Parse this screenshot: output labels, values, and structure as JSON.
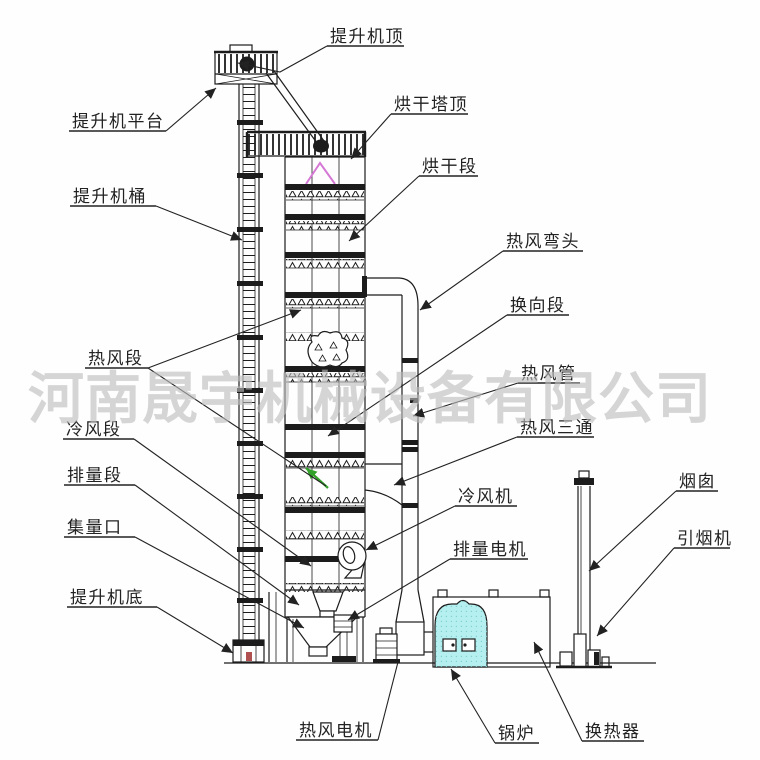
{
  "watermark": "河南晟宇机械设备有限公司",
  "labels": {
    "elevator_top": "提升机顶",
    "elevator_platform": "提升机平台",
    "elevator_bucket": "提升机桶",
    "drying_tower_top": "烘干塔顶",
    "drying_section": "烘干段",
    "hot_air_elbow": "热风弯头",
    "reversing_section": "换向段",
    "hot_air_pipe": "热风管",
    "hot_air_tee": "热风三通",
    "hot_air_section": "热风段",
    "cold_air_section": "冷风段",
    "discharge_section": "排量段",
    "collection_port": "集量口",
    "elevator_bottom": "提升机底",
    "cold_air_fan": "冷风机",
    "discharge_motor": "排量电机",
    "chimney": "烟囱",
    "smoke_fan": "引烟机",
    "hot_air_motor": "热风电机",
    "boiler": "锅炉",
    "heat_exchanger": "换热器"
  },
  "colors": {
    "line": "#1c1c1c",
    "label_text": "#222222",
    "boiler_fill": "#b6efef",
    "green_arrow": "#33a22a",
    "magenta_mark": "#d678d6",
    "watermark_gray": "#bdbdbd"
  }
}
